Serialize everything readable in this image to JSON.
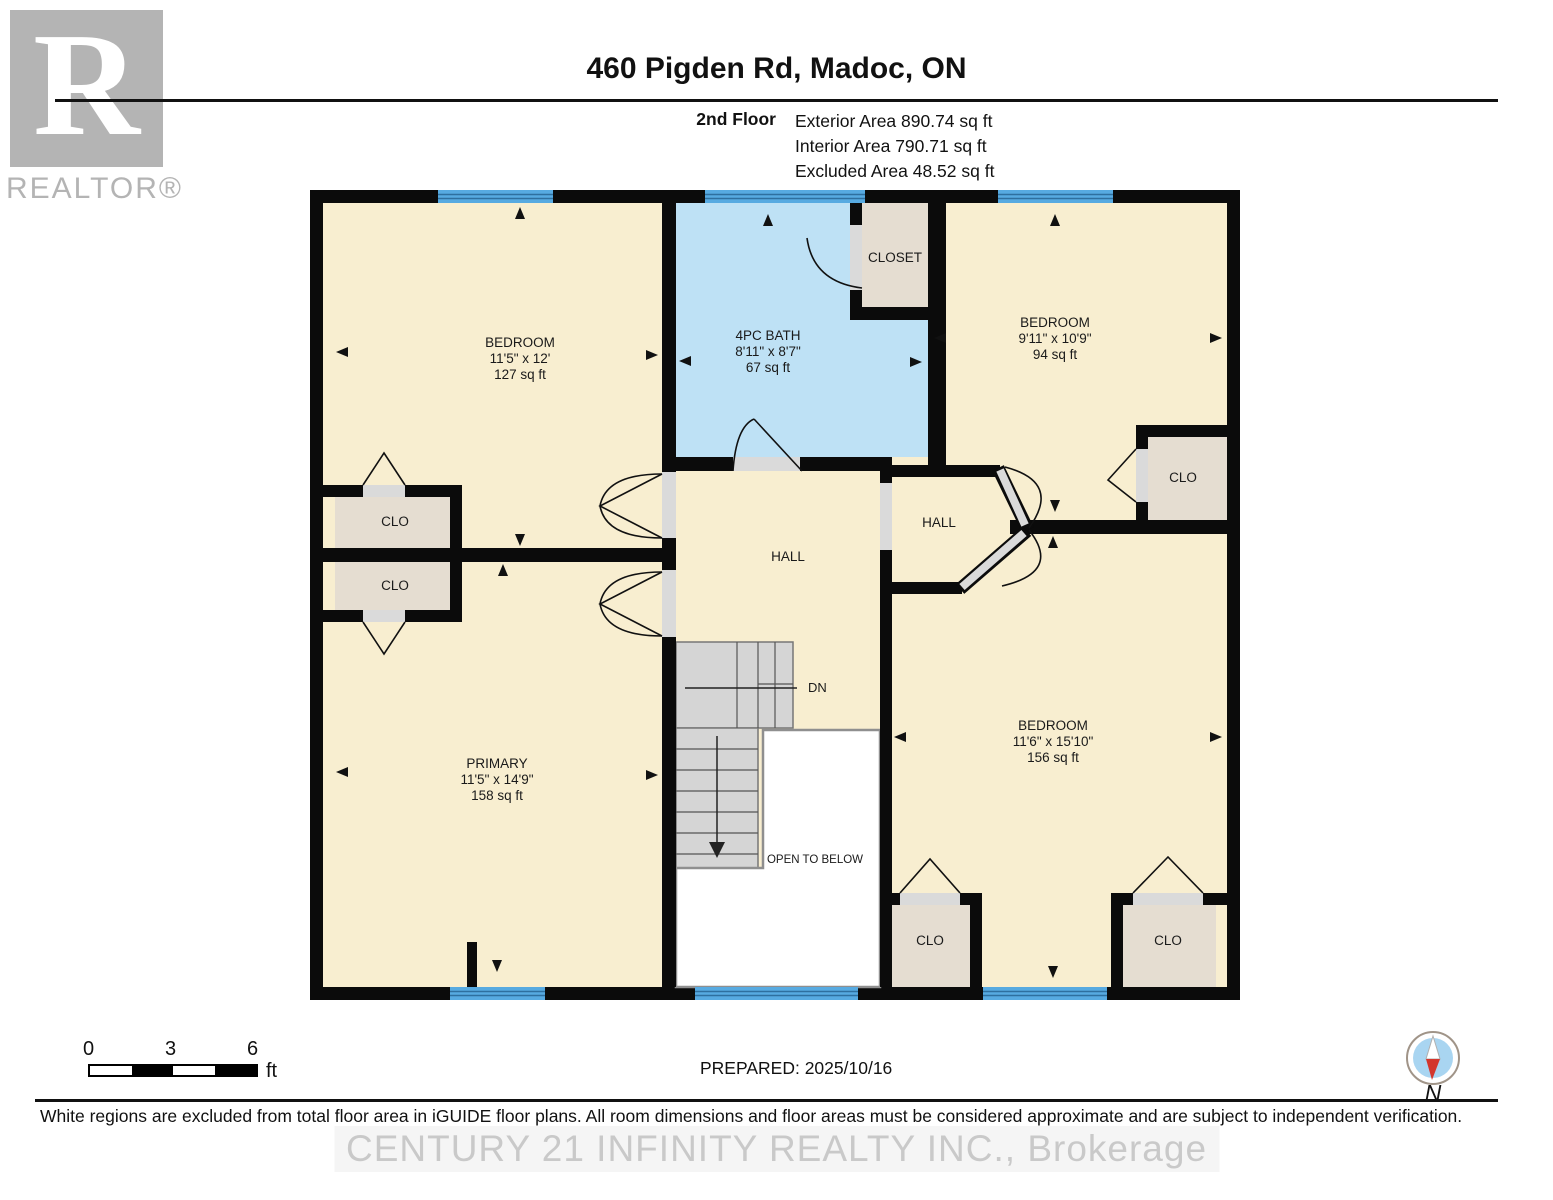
{
  "header": {
    "title": "460 Pigden Rd, Madoc, ON",
    "floor_label": "2nd Floor",
    "stats": [
      "Exterior Area 890.74 sq ft",
      "Interior Area 790.71 sq ft",
      "Excluded Area 48.52 sq ft"
    ]
  },
  "branding": {
    "logo_letter": "R",
    "logo_text": "REALTOR®",
    "watermark": "CENTURY 21 INFINITY REALTY INC., Brokerage"
  },
  "plan": {
    "bedroom_tl": {
      "name": "BEDROOM",
      "dims": "11'5\" x 12'",
      "area": "127 sq ft"
    },
    "bath": {
      "name": "4PC BATH",
      "dims": "8'11\" x 8'7\"",
      "area": "67 sq ft"
    },
    "closet_top": {
      "name": "CLOSET"
    },
    "bedroom_tr": {
      "name": "BEDROOM",
      "dims": "9'11\" x 10'9\"",
      "area": "94 sq ft"
    },
    "clo_tr": {
      "name": "CLO"
    },
    "clo_left_upper": {
      "name": "CLO"
    },
    "clo_left_lower": {
      "name": "CLO"
    },
    "hall_center": {
      "name": "HALL"
    },
    "hall_right": {
      "name": "HALL"
    },
    "primary": {
      "name": "PRIMARY",
      "dims": "11'5\" x 14'9\"",
      "area": "158 sq ft"
    },
    "bedroom_br": {
      "name": "BEDROOM",
      "dims": "11'6\" x 15'10\"",
      "area": "156 sq ft"
    },
    "clo_bottom_left": {
      "name": "CLO"
    },
    "clo_bottom_right": {
      "name": "CLO"
    },
    "stairs": {
      "label": "DN"
    },
    "open_to_below": {
      "label": "OPEN TO BELOW"
    }
  },
  "footer": {
    "scale": {
      "t0": "0",
      "t3": "3",
      "t6": "6",
      "unit": "ft"
    },
    "prepared": "PREPARED: 2025/10/16",
    "compass_label": "N",
    "disclaimer": "White regions are excluded from total floor area in iGUIDE floor plans. All room dimensions and floor areas must be considered approximate and are subject to independent verification."
  },
  "colors": {
    "wall": "#0b0b0b",
    "room_fill": "#F8EED0",
    "bath_fill": "#BEE1F5",
    "closet_fill": "#E5DDD1",
    "window_blue": "#57AAE1",
    "stair_gray": "#D5D5D5",
    "compass_blue": "#A9D5F1",
    "compass_red": "#D3362D",
    "logo_gray": "#B4B4B4"
  }
}
